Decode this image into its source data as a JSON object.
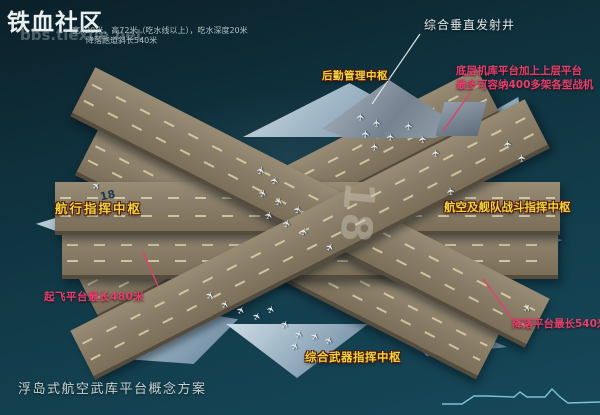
{
  "site": {
    "name": "铁血社区",
    "url": "bbs.tiexue.net"
  },
  "specs": {
    "line1": "宽420米，高72米（吃水线以上），吃水深度20米",
    "line2": "降落跑道斜长540米"
  },
  "annotations": {
    "vls": "综合垂直发射井",
    "logistics": "后勤管理中枢",
    "hangar_line1": "底层机库平台加上上层平台",
    "hangar_line2": "最多可容纳400多架各型战机",
    "navigation": "航行指挥中枢",
    "air_fleet": "航空及舰队战斗指挥中枢",
    "takeoff": "起飞平台最长480米",
    "weapons": "综合武器指挥中枢",
    "landing": "降落平台最长540米"
  },
  "caption": "浮岛式航空武库平台概念方案",
  "platform": {
    "runway_number_main": "18",
    "runway_number_side": "18"
  },
  "icons": {
    "aircraft_icon": "✈"
  },
  "colors": {
    "accent_yellow": "#e9d73c",
    "accent_red": "#e2406b",
    "label_white": "#e4eaea",
    "ocean_dark": "#0b2029",
    "ocean_light": "#16485a",
    "runway_tan": "#8a7d68",
    "pontoon_blue": "#9db4c4",
    "wave_line": "#7ec2d6"
  }
}
